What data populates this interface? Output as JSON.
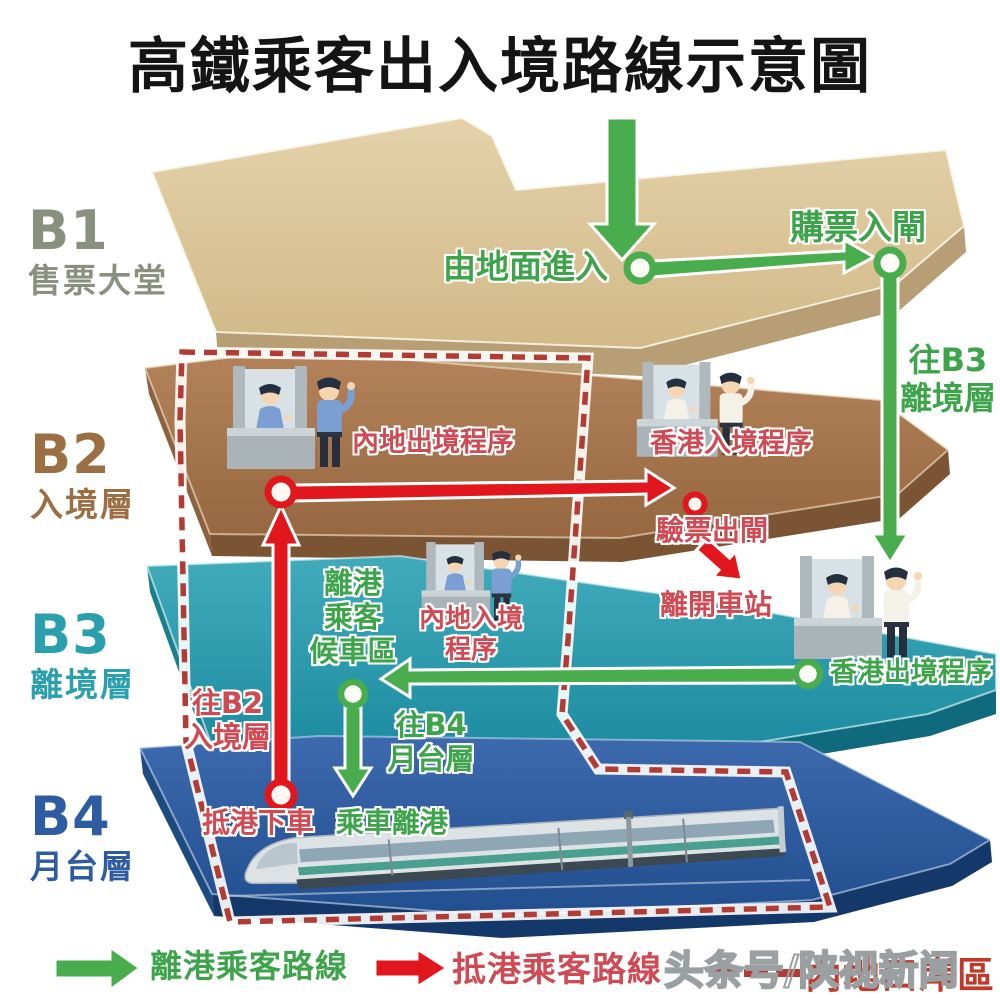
{
  "title": "高鐵乘客出入境路線示意圖",
  "levels": {
    "b1": {
      "id": "B1",
      "name": "售票大堂"
    },
    "b2": {
      "id": "B2",
      "name": "入境層"
    },
    "b3": {
      "id": "B3",
      "name": "離境層"
    },
    "b4": {
      "id": "B4",
      "name": "月台層"
    }
  },
  "labels": {
    "enter_from_ground": "由地面進入",
    "buy_ticket_enter_gate": "購票入閘",
    "to_b3_departure_level": "往B3\n離境層",
    "mainland_exit_procedure": "內地出境程序",
    "hk_entry_procedure": "香港入境程序",
    "ticket_check_exit_gate": "驗票出閘",
    "leave_station": "離開車站",
    "departure_waiting_area": "離港\n乘客\n候車區",
    "mainland_entry_procedure": "內地入境\n程序",
    "hk_exit_procedure": "香港出境程序",
    "to_b2_arrival_level": "往B2\n入境層",
    "to_b4_platform_level": "往B4\n月台層",
    "arrive_alight": "抵港下車",
    "board_depart": "乘車離港"
  },
  "legend": {
    "departure_route": "離港乘客路線",
    "arrival_route": "抵港乘客路線",
    "mainland_port_area": "內地口岸區"
  },
  "watermark": "头条号/陕视新闻",
  "colors": {
    "departure_green": "#43a047",
    "arrival_red": "#e2161d",
    "boundary_dash_red": "#b23c34",
    "b1_floor_tan": "#d8c294",
    "b2_floor_brown": "#a3754a",
    "b3_floor_teal": "#2397a9",
    "b4_floor_blue": "#2a5699",
    "label_green_text": "#3ea44b",
    "label_red_text": "#cf4a52"
  },
  "icons": {
    "booth": "immigration-counter-with-officers-icon",
    "train": "high-speed-train-icon",
    "green_arrow": "departure-route-arrow-icon",
    "red_arrow": "arrival-route-arrow-icon",
    "dashed_boundary": "mainland-port-area-boundary-icon"
  }
}
